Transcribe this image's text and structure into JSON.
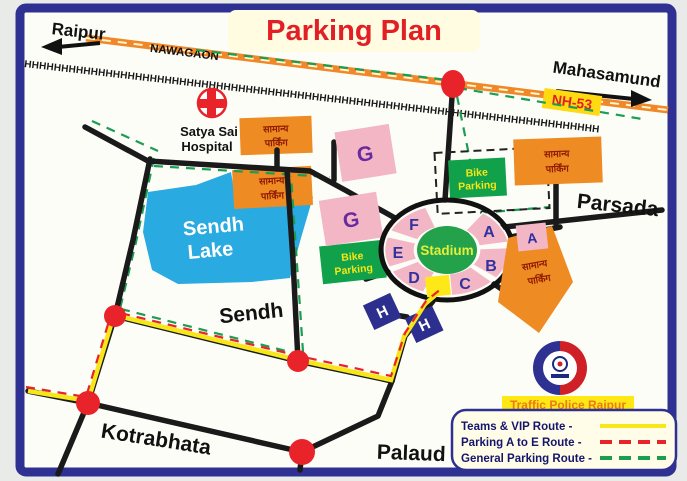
{
  "title": "Parking Plan",
  "colors": {
    "border_navy": "#2e3192",
    "title_red": "#e31f26",
    "road_black": "#1a1a1a",
    "nh53_orange": "#f0882a",
    "lake_blue": "#29aae1",
    "stadium_green": "#23a24b",
    "parking_orange": "#ef8b23",
    "zone_pink": "#f2b6c4",
    "zone_navy": "#2d2f8f",
    "bike_green": "#12a14b",
    "vip_yellow": "#f7e71a",
    "route_red": "#e8232a",
    "route_green": "#1b9d52",
    "junction_red": "#e8232a"
  },
  "places": {
    "raipur": "Raipur",
    "nawagaon": "NAWAGAON",
    "mahasamund": "Mahasamund",
    "nh53": "NH-53",
    "parsada": "Parsada",
    "sendh_road": "Sendh",
    "kotrabhata": "Kotrabhata",
    "palaud": "Palaud",
    "hospital_line1": "Satya Sai",
    "hospital_line2": "Hospital",
    "lake_line1": "Sendh",
    "lake_line2": "Lake"
  },
  "railway": {
    "track_glyphs": "HHHHHHHHHHHHHHHHHHHHHHHHHHHHHHHHHHHHHHHHHHHHHHHHHHHHHHHHHHHHHHHHHHHHHHHHHHHHHH"
  },
  "stadium": {
    "label": "Stadium",
    "sections": [
      "A",
      "B",
      "C",
      "D",
      "E",
      "F"
    ]
  },
  "parking": {
    "general_line1": "सामान्य",
    "general_line2": "पार्किंग",
    "bike_line1": "Bike",
    "bike_line2": "Parking",
    "zone_g": "G",
    "zone_h": "H",
    "zone_a": "A"
  },
  "legend": {
    "banner": "Traffic Police Raipur",
    "items": [
      {
        "label": "Teams & VIP Route -",
        "color": "#f7e71a",
        "style": "solid"
      },
      {
        "label": "Parking A to E Route -",
        "color": "#e8232a",
        "style": "dashed"
      },
      {
        "label": "General Parking Route -",
        "color": "#1b9d52",
        "style": "dashed"
      }
    ]
  }
}
